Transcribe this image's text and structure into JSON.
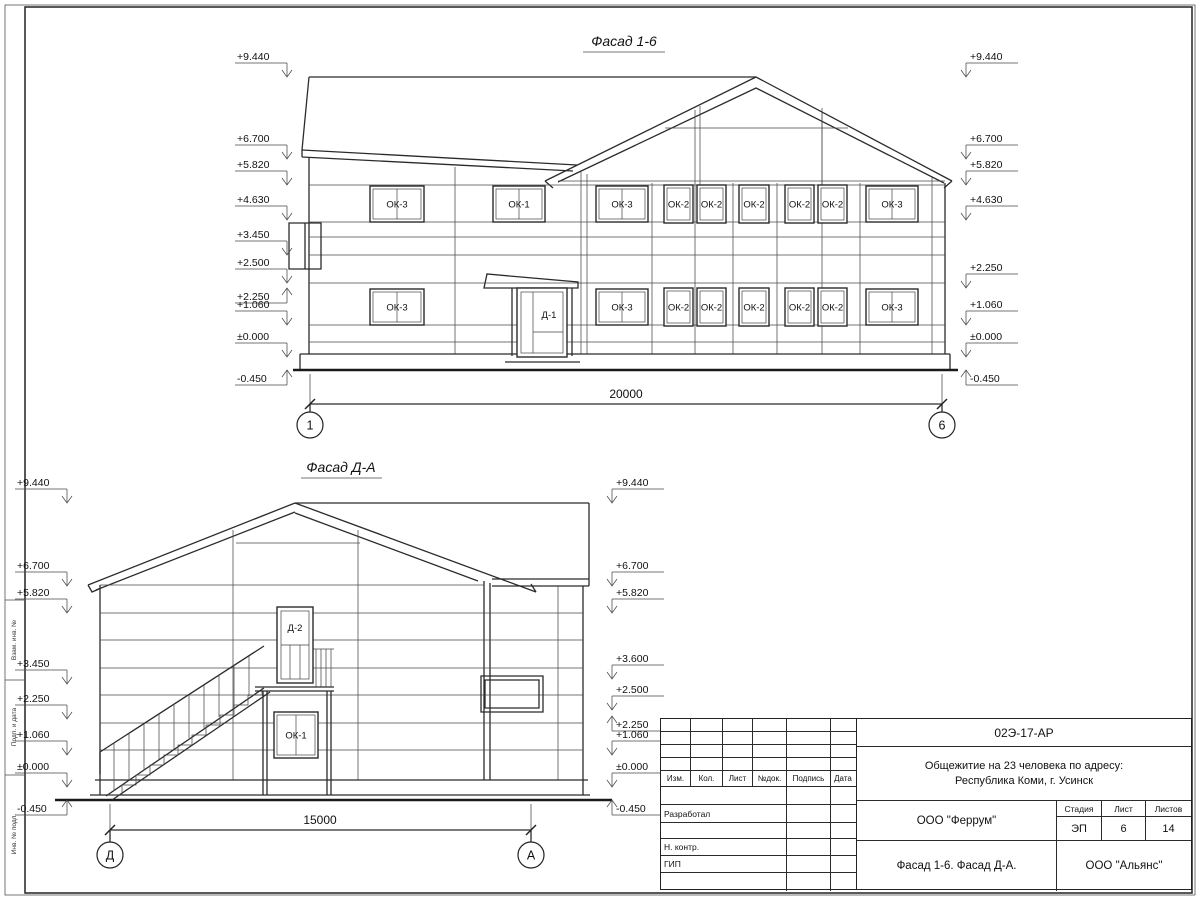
{
  "sheet": {
    "facade16": {
      "title": "Фасад 1-6",
      "dimension": "20000",
      "axis_left": "1",
      "axis_right": "6",
      "marks_left_x": 287,
      "marks_right_x": 966,
      "marks_left": [
        {
          "v": "+9.440",
          "y": 77,
          "d": "down"
        },
        {
          "v": "+6.700",
          "y": 159,
          "d": "down"
        },
        {
          "v": "+5.820",
          "y": 185,
          "d": "down"
        },
        {
          "v": "+4.630",
          "y": 220,
          "d": "down"
        },
        {
          "v": "+3.450",
          "y": 255,
          "d": "down"
        },
        {
          "v": "+2.500",
          "y": 283,
          "d": "down"
        },
        {
          "v": "+2.250",
          "y": 288,
          "d": "up"
        },
        {
          "v": "+1.060",
          "y": 325,
          "d": "down"
        },
        {
          "v": "±0.000",
          "y": 357,
          "d": "down"
        },
        {
          "v": "-0.450",
          "y": 370,
          "d": "up"
        }
      ],
      "marks_right": [
        {
          "v": "+9.440",
          "y": 77,
          "d": "down"
        },
        {
          "v": "+6.700",
          "y": 159,
          "d": "down"
        },
        {
          "v": "+5.820",
          "y": 185,
          "d": "down"
        },
        {
          "v": "+4.630",
          "y": 220,
          "d": "down"
        },
        {
          "v": "+2.250",
          "y": 288,
          "d": "down"
        },
        {
          "v": "+1.060",
          "y": 325,
          "d": "down"
        },
        {
          "v": "±0.000",
          "y": 357,
          "d": "down"
        },
        {
          "v": "-0.450",
          "y": 370,
          "d": "up"
        }
      ],
      "windows": [
        {
          "l": "ОК-3",
          "x": 370,
          "y": 186,
          "w": 54,
          "h": 36
        },
        {
          "l": "ОК-1",
          "x": 493,
          "y": 186,
          "w": 52,
          "h": 36
        },
        {
          "l": "ОК-3",
          "x": 596,
          "y": 186,
          "w": 52,
          "h": 36
        },
        {
          "l": "ОК-2",
          "x": 664,
          "y": 185,
          "w": 29,
          "h": 38
        },
        {
          "l": "ОК-2",
          "x": 697,
          "y": 185,
          "w": 29,
          "h": 38
        },
        {
          "l": "ОК-2",
          "x": 739,
          "y": 185,
          "w": 30,
          "h": 38
        },
        {
          "l": "ОК-2",
          "x": 785,
          "y": 185,
          "w": 29,
          "h": 38
        },
        {
          "l": "ОК-2",
          "x": 818,
          "y": 185,
          "w": 29,
          "h": 38
        },
        {
          "l": "ОК-3",
          "x": 866,
          "y": 186,
          "w": 52,
          "h": 36
        },
        {
          "l": "ОК-3",
          "x": 370,
          "y": 289,
          "w": 54,
          "h": 36
        },
        {
          "l": "ОК-3",
          "x": 596,
          "y": 289,
          "w": 52,
          "h": 36
        },
        {
          "l": "ОК-2",
          "x": 664,
          "y": 288,
          "w": 29,
          "h": 38
        },
        {
          "l": "ОК-2",
          "x": 697,
          "y": 288,
          "w": 29,
          "h": 38
        },
        {
          "l": "ОК-2",
          "x": 739,
          "y": 288,
          "w": 30,
          "h": 38
        },
        {
          "l": "ОК-2",
          "x": 785,
          "y": 288,
          "w": 29,
          "h": 38
        },
        {
          "l": "ОК-2",
          "x": 818,
          "y": 288,
          "w": 29,
          "h": 38
        },
        {
          "l": "ОК-3",
          "x": 866,
          "y": 289,
          "w": 52,
          "h": 36
        }
      ],
      "door": {
        "l": "Д-1",
        "x": 517,
        "y": 288,
        "w": 50,
        "h": 69
      }
    },
    "facadeDA": {
      "title": "Фасад Д-А",
      "dimension": "15000",
      "axis_left": "Д",
      "axis_right": "А",
      "marks_left_x": 67,
      "marks_right_x": 612,
      "marks_left": [
        {
          "v": "+9.440",
          "y": 503,
          "d": "down"
        },
        {
          "v": "+6.700",
          "y": 586,
          "d": "down"
        },
        {
          "v": "+5.820",
          "y": 613,
          "d": "down"
        },
        {
          "v": "+3.450",
          "y": 684,
          "d": "down"
        },
        {
          "v": "+2.250",
          "y": 719,
          "d": "down"
        },
        {
          "v": "+1.060",
          "y": 755,
          "d": "down"
        },
        {
          "v": "±0.000",
          "y": 787,
          "d": "down"
        },
        {
          "v": "-0.450",
          "y": 800,
          "d": "up"
        }
      ],
      "marks_right": [
        {
          "v": "+9.440",
          "y": 503,
          "d": "down"
        },
        {
          "v": "+6.700",
          "y": 586,
          "d": "down"
        },
        {
          "v": "+5.820",
          "y": 613,
          "d": "down"
        },
        {
          "v": "+3.600",
          "y": 679,
          "d": "down"
        },
        {
          "v": "+2.500",
          "y": 710,
          "d": "down"
        },
        {
          "v": "+2.250",
          "y": 716,
          "d": "up"
        },
        {
          "v": "+1.060",
          "y": 755,
          "d": "down"
        },
        {
          "v": "±0.000",
          "y": 787,
          "d": "down"
        },
        {
          "v": "-0.450",
          "y": 800,
          "d": "up"
        }
      ],
      "door": {
        "l": "Д-2",
        "x": 277,
        "y": 607,
        "w": 36,
        "h": 76
      },
      "window": {
        "l": "ОК-1",
        "x": 274,
        "y": 712,
        "w": 44,
        "h": 46
      }
    },
    "frame": {
      "side_labels": [
        "Взам. инв. №",
        "Подп. и дата",
        "Инв. № подл."
      ]
    },
    "title_block": {
      "doc_code": "02Э-17-АР",
      "project_line1": "Общежитие на 23 человека по адресу:",
      "project_line2": "Республика Коми, г. Усинск",
      "cols": [
        "Изм.",
        "Кол.",
        "Лист",
        "№док.",
        "Подпись",
        "Дата"
      ],
      "row_developed": "Разработал",
      "row_ncontr": "Н. контр.",
      "row_gip": "ГИП",
      "designer_org": "ООО \"Феррум\"",
      "stage_label": "Стадия",
      "sheet_label": "Лист",
      "sheets_label": "Листов",
      "stage": "ЭП",
      "sheet_no": "6",
      "sheets_total": "14",
      "sheet_name": "Фасад 1-6. Фасад Д-А.",
      "contractor_org": "ООО \"Альянс\""
    }
  }
}
